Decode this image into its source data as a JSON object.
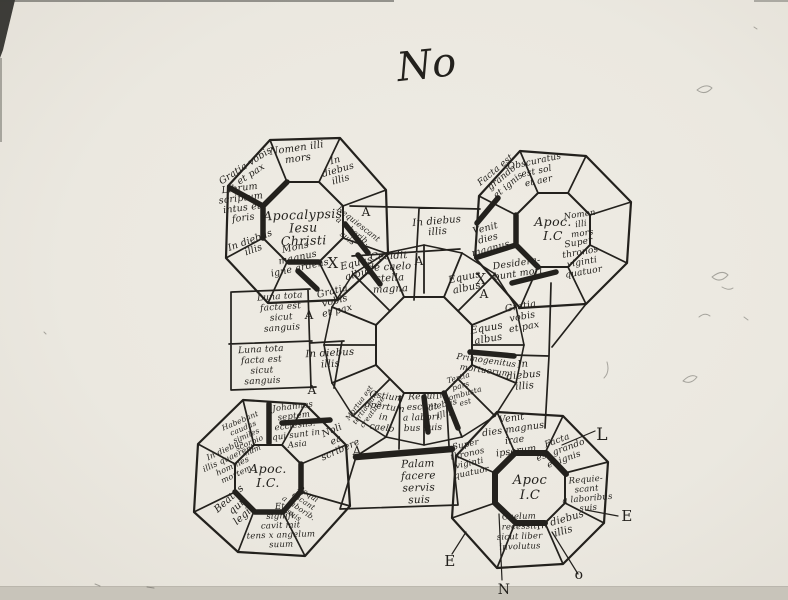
{
  "page": {
    "description": "Hand-drawn schematic sketch of an Apocalypse manuscript carpet-page: four corner octagonal rosettes with Latin inscriptions around a central wheel",
    "ink_color": "#23211d",
    "paper_color": "#ebe8e0",
    "page_mark": "No"
  },
  "diagram": {
    "rosette_titles": [
      "Apocalypsis Iesu Christi",
      "Apoc. I.C",
      "Apoc. I.C.",
      "Apoc I.C"
    ],
    "margin_letters": [
      "L",
      "E",
      "E",
      "N",
      "o"
    ],
    "labels": [
      {
        "text": "No",
        "x": 428,
        "y": 78,
        "rot": -6,
        "size": 40,
        "cls": "mark",
        "name": "page-number-mark"
      },
      {
        "text": "Nomen illi\nmors",
        "x": 297,
        "y": 151,
        "rot": -8,
        "size": 10
      },
      {
        "text": "Gratia vobis\net pax",
        "x": 247,
        "y": 168,
        "rot": -33,
        "size": 9.5
      },
      {
        "text": "In\ndiebus\nillis",
        "x": 336,
        "y": 163,
        "rot": -16,
        "size": 9.5
      },
      {
        "text": "Librum\nscriptum\nintus et\nforis",
        "x": 240,
        "y": 191,
        "rot": -7,
        "size": 9.5
      },
      {
        "text": "Apocalypsis\nIesu\nChristi",
        "x": 303,
        "y": 219,
        "rot": -2,
        "size": 12.5,
        "lh": 13,
        "name": "rosette-title-top-left",
        "cls": "title"
      },
      {
        "text": "Requiescant\na laborib.\nsuis",
        "x": 357,
        "y": 226,
        "rot": 38,
        "size": 8,
        "lh": 9
      },
      {
        "text": "In diebus\nillis",
        "x": 251,
        "y": 243,
        "rot": -20,
        "size": 9.5
      },
      {
        "text": "Mons\nmagnus\nigne ardens",
        "x": 296,
        "y": 250,
        "rot": -12,
        "size": 9.5,
        "lh": 10.5
      },
      {
        "text": "X",
        "x": 333,
        "y": 268,
        "size": 15,
        "cls": "cap",
        "name": "x-mark"
      },
      {
        "text": "A",
        "x": 366,
        "y": 216,
        "size": 12,
        "cls": "cap",
        "name": "letter-a"
      },
      {
        "text": "In diebus\nillis",
        "x": 437,
        "y": 224,
        "rot": -5,
        "size": 10
      },
      {
        "text": "A",
        "x": 419,
        "y": 265,
        "size": 12,
        "cls": "cap",
        "name": "letter-a"
      },
      {
        "text": "Cecidit\nde caelo\nstella\nmagna",
        "x": 389,
        "y": 259,
        "rot": -3,
        "size": 10,
        "lh": 11
      },
      {
        "text": "Equus\nalbus",
        "x": 357,
        "y": 266,
        "rot": -14,
        "size": 10,
        "lh": 11
      },
      {
        "text": "Venit\ndies\nmagnus",
        "x": 486,
        "y": 231,
        "rot": -15,
        "size": 9.5,
        "lh": 10.5
      },
      {
        "text": "Equus\nalbus",
        "x": 465,
        "y": 280,
        "rot": -12,
        "size": 10,
        "lh": 11
      },
      {
        "text": "X",
        "x": 481,
        "y": 284,
        "size": 15,
        "cls": "cap",
        "name": "x-mark"
      },
      {
        "text": "A",
        "x": 484,
        "y": 298,
        "size": 12,
        "cls": "cap",
        "name": "letter-a"
      },
      {
        "text": "Obscuratus\nest sol\net aer",
        "x": 535,
        "y": 164,
        "rot": -12,
        "size": 9,
        "lh": 10
      },
      {
        "text": "Facta est\ngrando\net ignis",
        "x": 497,
        "y": 172,
        "rot": -40,
        "size": 9,
        "lh": 10
      },
      {
        "text": "Apoc.\nI.C",
        "x": 553,
        "y": 226,
        "size": 12.5,
        "lh": 14,
        "name": "rosette-title-top-right",
        "cls": "title"
      },
      {
        "text": "Nomen\nilli\nmors",
        "x": 580,
        "y": 217,
        "rot": -8,
        "size": 8.5,
        "lh": 9.5
      },
      {
        "text": "Super\nthronos\nviginti\nquatuor",
        "x": 579,
        "y": 245,
        "rot": -10,
        "size": 9,
        "lh": 10
      },
      {
        "text": "Desidera-\nbunt mori",
        "x": 517,
        "y": 266,
        "rot": -8,
        "size": 9.5,
        "lh": 10.5
      },
      {
        "text": "Gratia\nvobis\net pax",
        "x": 521,
        "y": 309,
        "rot": -10,
        "size": 9.5,
        "lh": 10.5
      },
      {
        "text": "Equus\nalbus",
        "x": 487,
        "y": 331,
        "rot": -10,
        "size": 10,
        "lh": 11
      },
      {
        "text": "Primogenitus\nmortuorum",
        "x": 486,
        "y": 363,
        "rot": 8,
        "size": 8.5,
        "lh": 10
      },
      {
        "text": "In\ndiebus\nillis",
        "x": 523,
        "y": 367,
        "rot": -5,
        "size": 10,
        "lh": 11
      },
      {
        "text": "Luna tota\nfacta est\nsicut\nsanguis",
        "x": 280,
        "y": 299,
        "rot": -4,
        "size": 9,
        "lh": 10.5
      },
      {
        "text": "Gratia\nvobis\net pax",
        "x": 333,
        "y": 294,
        "rot": -14,
        "size": 9.5,
        "lh": 10
      },
      {
        "text": "A",
        "x": 309,
        "y": 319,
        "size": 12,
        "cls": "cap",
        "name": "letter-a"
      },
      {
        "text": "Luna tota\nfacta est\nsicut\nsanguis",
        "x": 261,
        "y": 352,
        "rot": -3,
        "size": 9,
        "lh": 10.5
      },
      {
        "text": "In diebus\nillis",
        "x": 330,
        "y": 356,
        "rot": -3,
        "size": 10,
        "lh": 11
      },
      {
        "text": "A",
        "x": 312,
        "y": 394,
        "size": 12,
        "cls": "cap",
        "name": "letter-a"
      },
      {
        "text": "Tertia\npars\ncombusta\nest",
        "x": 459,
        "y": 380,
        "rot": -16,
        "size": 7.5,
        "lh": 8.5
      },
      {
        "text": "In\ndiebus\nillis",
        "x": 441,
        "y": 398,
        "rot": -14,
        "size": 8.5,
        "lh": 9.5
      },
      {
        "text": "Venit\ndies magnus\nirae\nipsorum",
        "x": 512,
        "y": 421,
        "rot": -8,
        "size": 9.5,
        "lh": 11
      },
      {
        "text": "Ostium\napertum\nin\ncaelo",
        "x": 386,
        "y": 399,
        "rot": 8,
        "size": 9,
        "lh": 10.5
      },
      {
        "text": "Requi\nescant\na labori.\nbus suis",
        "x": 422,
        "y": 399,
        "rot": -2,
        "size": 9,
        "lh": 10.5
      },
      {
        "text": "Mortua est\ntertia pars\ncreaturae",
        "x": 361,
        "y": 404,
        "rot": -54,
        "size": 7,
        "lh": 8
      },
      {
        "text": "Noli\nea\nscribere",
        "x": 333,
        "y": 433,
        "rot": -24,
        "size": 9.5,
        "lh": 10.5
      },
      {
        "text": "A",
        "x": 357,
        "y": 455,
        "size": 12,
        "cls": "cap",
        "name": "letter-a"
      },
      {
        "text": "Palam\nfacere\nservis\nsuis",
        "x": 418,
        "y": 467,
        "rot": -2,
        "size": 10.5,
        "lh": 12
      },
      {
        "text": "Super\nthronos\nviginti\nquatuor",
        "x": 466,
        "y": 447,
        "rot": -12,
        "size": 8.5,
        "lh": 9.5
      },
      {
        "text": "Johannes\nseptem\necclesiis.\nqui sunt in\nAsia",
        "x": 293,
        "y": 409,
        "rot": -7,
        "size": 8.5,
        "lh": 9.5
      },
      {
        "text": "Habebant\ncaudas\nsimiles\nscorpio\nnum",
        "x": 241,
        "y": 423,
        "rot": -23,
        "size": 7.5,
        "lh": 8
      },
      {
        "text": "In diebus\nillis quaerent\nhomines\nmortem",
        "x": 226,
        "y": 452,
        "rot": -25,
        "size": 8,
        "lh": 9
      },
      {
        "text": "Beatus\nqui\nlegit",
        "x": 231,
        "y": 501,
        "rot": -42,
        "size": 10,
        "lh": 11
      },
      {
        "text": "Apoc.\nI.C.",
        "x": 268,
        "y": 473,
        "size": 12.5,
        "lh": 14,
        "name": "rosette-title-bottom-left",
        "cls": "title"
      },
      {
        "text": "Requi\nescant\na laborib.\nsuis",
        "x": 307,
        "y": 496,
        "rot": 34,
        "size": 7.5,
        "lh": 8.5
      },
      {
        "text": "Et\nsignifi\ncavit mit\ntens x angelum\nsuum",
        "x": 280,
        "y": 509,
        "rot": -2,
        "size": 8.5,
        "lh": 9.5
      },
      {
        "text": "Facta\nest grando\net ignis",
        "x": 558,
        "y": 443,
        "rot": -20,
        "size": 9,
        "lh": 10
      },
      {
        "text": "Apoc\nI.C",
        "x": 530,
        "y": 484,
        "size": 13,
        "lh": 15,
        "name": "rosette-title-bottom-right",
        "cls": "title"
      },
      {
        "text": "Requie-\nscant\na laboribus\nsuis",
        "x": 586,
        "y": 482,
        "rot": -5,
        "size": 8.5,
        "lh": 9.5
      },
      {
        "text": "In diebus\nillis",
        "x": 561,
        "y": 523,
        "rot": -16,
        "size": 10,
        "lh": 11.5
      },
      {
        "text": "Caelum\nrecessit\nsicut liber\ninvolutus",
        "x": 519,
        "y": 519,
        "rot": -2,
        "size": 8.5,
        "lh": 10
      },
      {
        "text": "L",
        "x": 602,
        "y": 440,
        "size": 17,
        "cls": "cap",
        "name": "margin-letter"
      },
      {
        "text": "E",
        "x": 627,
        "y": 521,
        "size": 15,
        "cls": "cap",
        "name": "margin-letter"
      },
      {
        "text": "E",
        "x": 450,
        "y": 566,
        "size": 15,
        "cls": "cap",
        "name": "margin-letter"
      },
      {
        "text": "N",
        "x": 504,
        "y": 594,
        "size": 14,
        "cls": "cap",
        "name": "margin-letter"
      },
      {
        "text": "o",
        "x": 579,
        "y": 579,
        "size": 14,
        "cls": "cap",
        "name": "margin-letter"
      }
    ]
  }
}
